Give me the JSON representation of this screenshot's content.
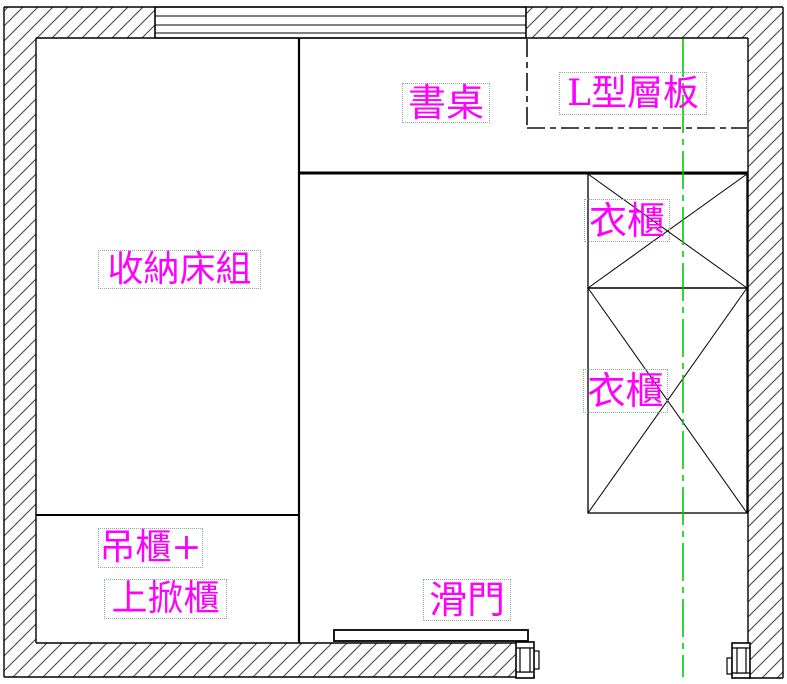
{
  "drawing_title": "bedroom furniture floor plan",
  "colors": {
    "label_text": "#ff00ff",
    "center_axis": "#00cc00",
    "line": "#000000",
    "label_box_border": "#8fa69b"
  },
  "labels": {
    "desk": {
      "text": "書桌"
    },
    "l_shelf": {
      "text": "L型層板"
    },
    "storage_bed": {
      "text": "收納床組"
    },
    "wardrobe_upper": {
      "text": "衣櫃"
    },
    "wardrobe_lower": {
      "text": "衣櫃"
    },
    "hanging_cabinet": {
      "text": "吊櫃+"
    },
    "liftup_cabinet": {
      "text": "上掀櫃"
    },
    "sliding_door": {
      "text": "滑門"
    }
  }
}
